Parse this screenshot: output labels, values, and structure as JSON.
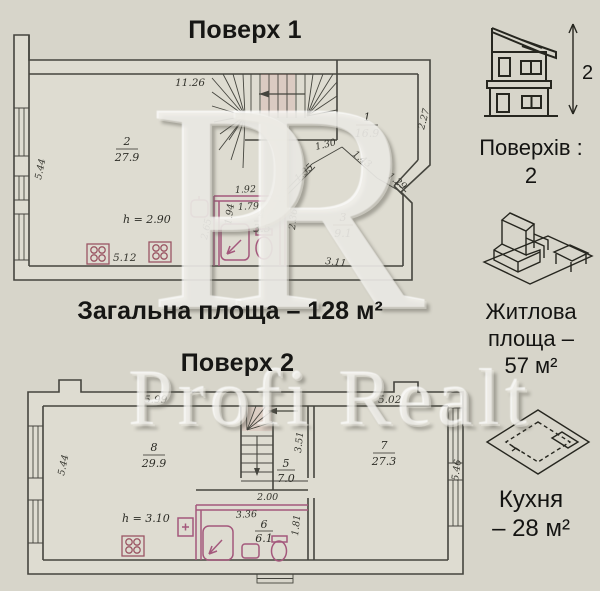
{
  "floor1": {
    "title": "Поверх 1",
    "height_label": "h = 2.90",
    "rooms": [
      {
        "number": "2",
        "area": "27.9"
      },
      {
        "number": "1",
        "area": "16.9"
      },
      {
        "number": "3",
        "area": "9.1"
      },
      {
        "number": "4",
        "area": "3.5"
      }
    ],
    "dims": {
      "top": "11.26",
      "left": "5.44",
      "right": "2.27",
      "bay_win1": "1.35",
      "bay_wall1": "1.30",
      "bay_wall2": "1.43",
      "bay_win2": "1.29",
      "bath_top": "1.92",
      "bath_top_inner": "1.79",
      "bath_left": "1.94",
      "bath_outer": "2.65",
      "bath_right": "2.36",
      "room3_bottom": "3.11",
      "kitchen_front": "5.12"
    }
  },
  "total_area": "Загальна площа – 128 м²",
  "floor2": {
    "title": "Поверх 2",
    "height_label": "h = 3.10",
    "rooms": [
      {
        "number": "8",
        "area": "29.9"
      },
      {
        "number": "5",
        "area": "7.0"
      },
      {
        "number": "6",
        "area": "6.1"
      },
      {
        "number": "7",
        "area": "27.3"
      }
    ],
    "dims": {
      "top_left": "5.99",
      "top_right": "5.02",
      "left": "5.44",
      "right": "5.46",
      "stair": "3.51",
      "hall": "2.00",
      "bath_top": "3.36",
      "bath_right": "1.81"
    }
  },
  "sidebar": {
    "floors": {
      "arrow_value": "2",
      "label": "Поверхів :",
      "value": "2"
    },
    "living": {
      "line1": "Житлова",
      "line2": "площа –",
      "line3": "57 м²"
    },
    "kitchen": {
      "line1": "Кухня",
      "line2": "– 28 м²"
    }
  },
  "watermark": {
    "monogram": "PR",
    "text": "Profi Realt"
  }
}
